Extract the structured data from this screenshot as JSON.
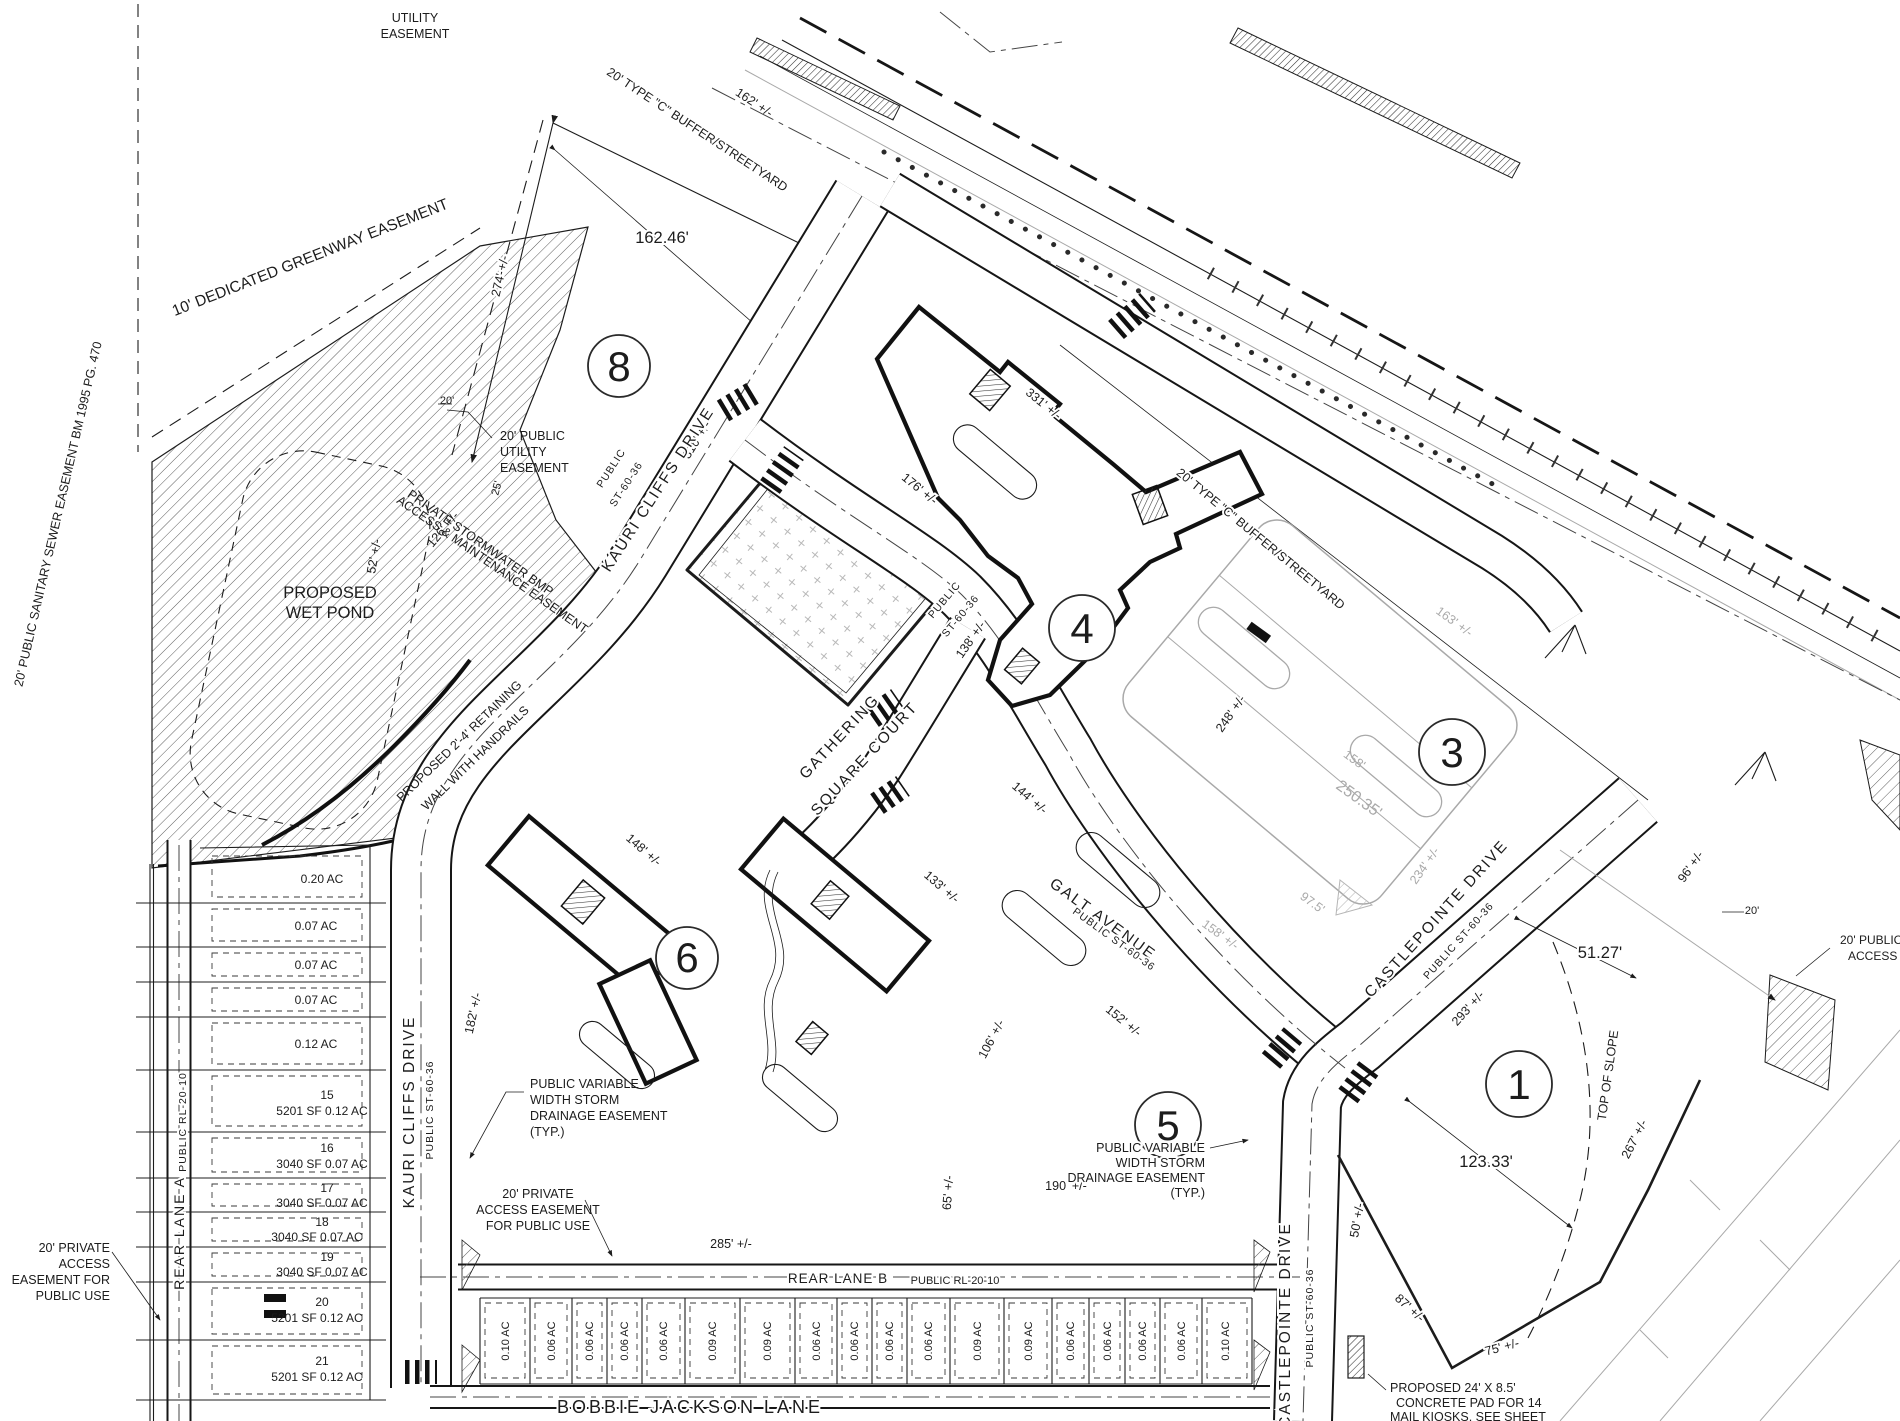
{
  "parcels": {
    "p1": "1",
    "p3": "3",
    "p4": "4",
    "p5": "5",
    "p6": "6",
    "p8": "8"
  },
  "streets": {
    "kauri_name": "KAURI CLIFFS DRIVE",
    "kauri_class": "PUBLIC ST-60-36",
    "kauri_class_l1": "PUBLIC",
    "kauri_class_l2": "ST-60-36",
    "gathering_l1": "GATHERING",
    "gathering_l2": "SQUARE COURT",
    "public_st_l1": "PUBLIC",
    "public_st_l2": "ST-60-36",
    "galt_name": "GALT AVENUE",
    "galt_class": "PUBLIC ST-60-36",
    "castlepointe_name": "CASTLEPOINTE DRIVE",
    "castlepointe_class": "PUBLIC ST-60-36",
    "rear_a_name": "REAR LANE A",
    "rear_a_class": "PUBLIC RL-20-10",
    "rear_b_name": "REAR LANE B",
    "rear_b_class": "PUBLIC RL-20-10",
    "bobbie_name": "BOBBIE JACKSON LANE"
  },
  "easements": {
    "utility_l1": "UTILITY",
    "utility_l2": "EASEMENT",
    "greenway": "10' DEDICATED GREENWAY EASEMENT",
    "sanitary": "20' PUBLIC SANITARY SEWER EASEMENT  BM 1995 PG. 470",
    "buffer": "20' TYPE \"C\" BUFFER/STREETYARD",
    "pue_l1": "20' PUBLIC",
    "pue_l2": "UTILITY",
    "pue_l3": "EASEMENT",
    "bmp_l1": "PRIVATE STORMWATER BMP",
    "bmp_l2": "ACCESS & MAINTENANCE EASEMENT",
    "retaining_l1": "PROPOSED 2'-4' RETAINING",
    "retaining_l2": "WALL WITH HANDRAILS",
    "storm_l1": "PUBLIC VARIABLE",
    "storm_l2": "WIDTH STORM",
    "storm_l3": "DRAINAGE EASEMENT",
    "storm_l4": "(TYP.)",
    "paccess_l1": "20' PRIVATE",
    "paccess_l2": "ACCESS EASEMENT",
    "paccess_l3": "FOR PUBLIC USE",
    "paccess_left_l1": "20' PRIVATE",
    "paccess_left_l2": "ACCESS",
    "paccess_left_l3": "EASEMENT FOR",
    "paccess_left_l4": "PUBLIC USE",
    "pub_access_l1": "20' PUBLIC",
    "pub_access_l2": "ACCESS"
  },
  "features": {
    "wet_pond_l1": "PROPOSED",
    "wet_pond_l2": "WET POND",
    "top_of_slope": "TOP OF SLOPE",
    "kiosk_l1": "PROPOSED 24' X 8.5'",
    "kiosk_l2": "CONCRETE PAD FOR 14",
    "kiosk_l3": "MAIL KIOSKS, SEE SHEET",
    "kiosk_l4": "C7.0 FOR DETAIL"
  },
  "dimensions": {
    "d274": "274' +/-",
    "d162": "162' +/-",
    "d162_46": "162.46'",
    "d316": "316' +/-",
    "d331": "331' +/-",
    "d176": "176' +/-",
    "d138": "138' +/-",
    "d144": "144' +/-",
    "d148": "148' +/-",
    "d133": "133' +/-",
    "d106": "106' +/-",
    "d152": "152' +/-",
    "d65": "65' +/-",
    "d285": "285' +/-",
    "d190": "190' +/-",
    "d182": "182' +/-",
    "d248": "248' +/-",
    "d158": "158'",
    "d250_35": "250.35'",
    "d97_5": "97.5'",
    "d234": "234' +/-",
    "d158b": "158' +/-",
    "d163": "163' +/-",
    "d293": "293' +/-",
    "d51_27": "51.27'",
    "d96": "96' +/-",
    "d123_33": "123.33'",
    "d267": "267' +/-",
    "d50": "50' +/-",
    "d87": "87' +/-",
    "d75": "75' +/-",
    "d52": "52' +/-",
    "d126": "126' +/-",
    "d25": "25'",
    "d20": "20'"
  },
  "left_lots": [
    {
      "area": "0.20 AC"
    },
    {
      "area": "0.07 AC"
    },
    {
      "area": "0.07 AC"
    },
    {
      "area": "0.07 AC"
    },
    {
      "area": "0.12 AC"
    },
    {
      "number": "15",
      "detail": "5201 SF  0.12 AC"
    },
    {
      "number": "16",
      "detail": "3040 SF  0.07 AC"
    },
    {
      "number": "17",
      "detail": "3040 SF  0.07 AC"
    },
    {
      "number": "18",
      "detail": "3040 SF  0.07 AC"
    },
    {
      "number": "19",
      "detail": "3040 SF  0.07 AC"
    },
    {
      "number": "20",
      "detail": "5201 SF  0.12 AC"
    },
    {
      "number": "21",
      "detail": "5201 SF  0.12 AC"
    }
  ],
  "bottom_lots": [
    "0.10 AC",
    "0.06 AC",
    "0.06 AC",
    "0.06 AC",
    "0.06 AC",
    "0.09 AC",
    "0.09 AC",
    "0.06 AC",
    "0.06 AC",
    "0.06 AC",
    "0.06 AC",
    "0.09 AC",
    "0.09 AC",
    "0.06 AC",
    "0.06 AC",
    "0.06 AC",
    "0.06 AC",
    "0.10 AC"
  ]
}
